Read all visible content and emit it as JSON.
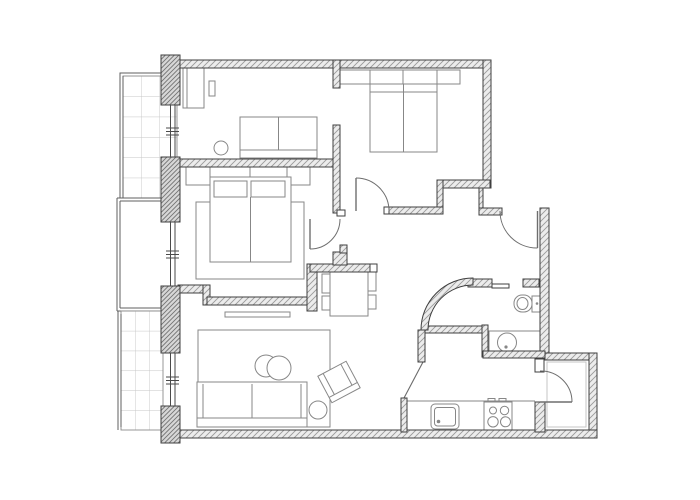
{
  "meta": {
    "title": "Two-bedroom apartment floor plan",
    "drawing_type": "architectural-floor-plan"
  },
  "canvas": {
    "width": 700,
    "height": 500,
    "background": "#ffffff"
  },
  "colors": {
    "wall_outline": "#3f3f3f",
    "wall_hatch": "#9a9a9a",
    "wall_fill": "#ececec",
    "pillar_hatch": "#737373",
    "pillar_fill": "#d7d7d7",
    "furniture_line": "#878787",
    "door_line": "#6e6e6e",
    "window_line": "#4a4a4a",
    "balcony_line": "#5f5f5f",
    "tile_grid": "#c6c6c6",
    "thin_line": "#6b6b6b"
  },
  "rooms": [
    {
      "name": "bedroom-top-left",
      "furniture": [
        "dresser",
        "wall-shelf",
        "loveseat",
        "round-stool"
      ]
    },
    {
      "name": "bedroom-top-right",
      "furniture": [
        "closet-row-4-sections",
        "double-bed"
      ]
    },
    {
      "name": "bedroom-middle-left",
      "furniture": [
        "headboard-shelf",
        "double-bed",
        "two-pillows",
        "area-rug"
      ]
    },
    {
      "name": "living-room",
      "furniture": [
        "tv-bench",
        "area-rug",
        "sofa",
        "nesting-coffee-tables",
        "armchair-rotated",
        "round-side-table"
      ]
    },
    {
      "name": "dining-area",
      "furniture": [
        "dining-table",
        "four-chairs"
      ]
    },
    {
      "name": "hallway",
      "furniture": []
    },
    {
      "name": "bathroom",
      "fixtures": [
        "toilet",
        "washbasin-counter"
      ]
    },
    {
      "name": "kitchen",
      "fixtures": [
        "worktop",
        "sink",
        "cooktop-4-burners"
      ]
    },
    {
      "name": "entry-vestibule",
      "fixtures": []
    }
  ],
  "balconies": [
    {
      "name": "balcony-upper",
      "tiled": true
    },
    {
      "name": "terrace-middle",
      "tiled": false
    },
    {
      "name": "balcony-lower",
      "tiled": true
    }
  ],
  "openings": {
    "hinged_doors": 4,
    "windows": 3,
    "wall_openings": 3,
    "curved_walls": 1
  }
}
